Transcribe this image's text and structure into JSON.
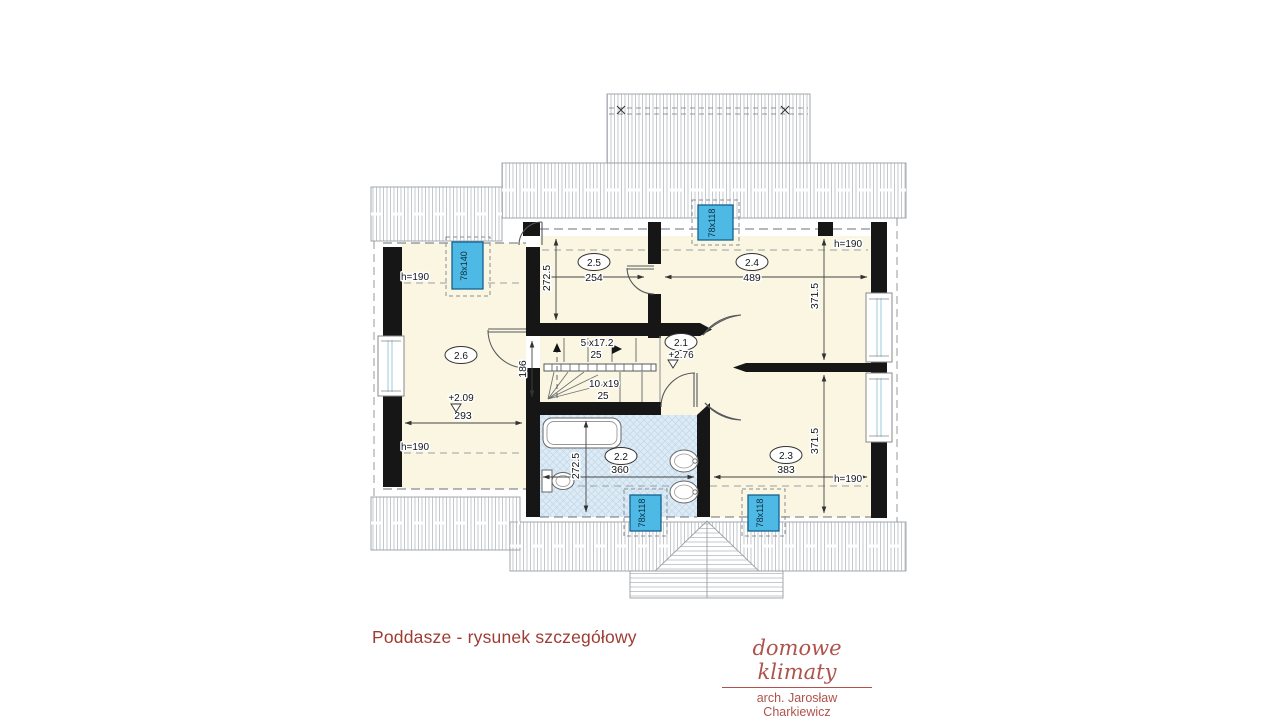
{
  "title": "Poddasze - rysunek szczegółowy",
  "logo": {
    "brand": "domowe klimaty",
    "architect": "arch. Jarosław Charkiewicz"
  },
  "rooms": {
    "r21": {
      "label": "2.1",
      "level": "+2.76"
    },
    "r22": {
      "label": "2.2",
      "width": "360",
      "height": "272.5"
    },
    "r23": {
      "label": "2.3",
      "width": "383",
      "height": "371.5",
      "knee": "h=190"
    },
    "r24": {
      "label": "2.4",
      "width": "489",
      "height": "371.5",
      "knee": "h=190"
    },
    "r25": {
      "label": "2.5",
      "width": "254",
      "height": "272.5"
    },
    "r26": {
      "label": "2.6",
      "width": "293",
      "level": "+2.09",
      "knee_top": "h=190",
      "knee_bottom": "h=190"
    }
  },
  "stairs": {
    "upper_steps": "5 x17.2",
    "upper_tread": "25",
    "lower_steps": "10 x19",
    "lower_tread": "25",
    "landing_depth": "186"
  },
  "skylights": {
    "left": "78x140",
    "top": "78x118",
    "bath": "78x118",
    "bottom_right": "78x118"
  },
  "colors": {
    "floor": "#faf6e2",
    "bath_floor": "#dcebf6",
    "skylight": "#4fb9e6",
    "wall": "#161616",
    "accent_red": "#9e3b33",
    "hatch_line": "#b6babf"
  }
}
